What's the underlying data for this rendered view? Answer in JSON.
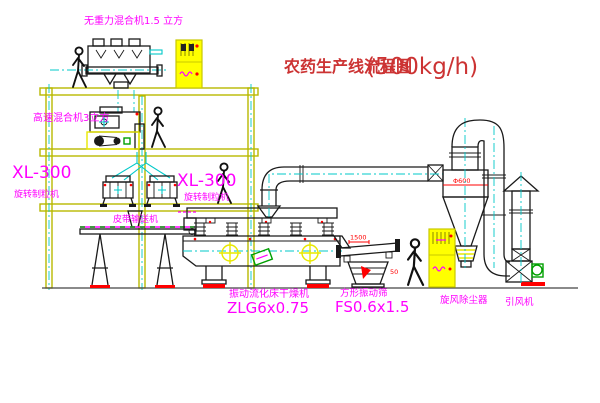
{
  "diagram": {
    "title": "农药生产线流程图",
    "title_capacity": "(500kg/h)"
  },
  "labels": {
    "gravity_mixer": "无重力混合机1.5 立方",
    "high_speed_mixer": "高速混合机3立方",
    "granulator_left_model": "XL-300",
    "granulator_left_name": "旋转制粒机",
    "granulator_right_model": "XL-300",
    "granulator_right_name": "旋转制粒机",
    "belt_conveyor": "皮带输送机",
    "fluid_bed_dryer_name": "振动流化床干燥机",
    "fluid_bed_dryer_model": "ZLG6x0.75",
    "vibrating_screen_name": "方形振动筛",
    "vibrating_screen_model": "FS0.6x1.5",
    "cyclone_dust_collector": "旋风除尘器",
    "induced_draft_fan": "引风机"
  },
  "dimensions": {
    "screen_length": "1500",
    "screen_side": "50",
    "cyclone_diameter": "Φ600"
  },
  "colors": {
    "background": "#ffffff",
    "structure_yellow": "#b8b800",
    "equipment_black": "#1a1a1a",
    "centerline_cyan": "#00c8c8",
    "label_magenta": "#ff00ff",
    "title_red": "#cc3333",
    "dimension_red": "#ff0000",
    "accent_green": "#00a000",
    "cabinet_yellow": "#ffff00"
  }
}
